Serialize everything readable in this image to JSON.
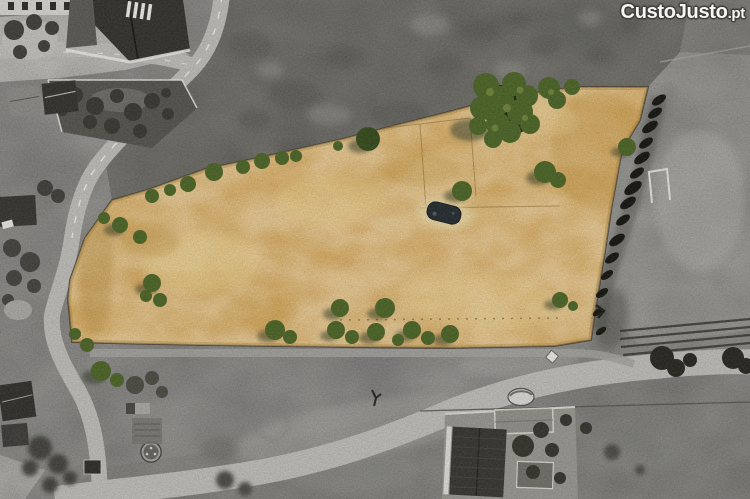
{
  "watermark": {
    "brand": "CustoJusto",
    "tld": ".pt"
  },
  "colors": {
    "plot_fill": "#d2a355",
    "tree_green": "#4a6324",
    "road_gray": "#bcbbb7",
    "background_gray": "#929290",
    "watermark_text": "#f7f6f3",
    "watermark_outline": "#3f3e3c"
  }
}
